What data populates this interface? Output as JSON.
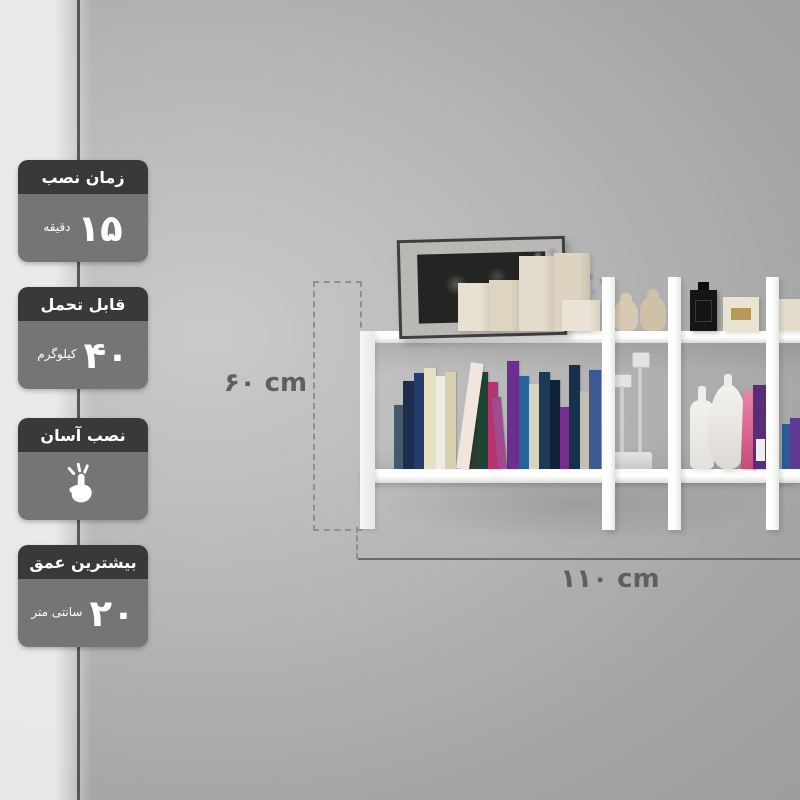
{
  "page": {
    "type": "product-infographic",
    "language": "fa",
    "subject": "wall-mounted-shelf"
  },
  "badges": [
    {
      "header": "زمان نصب",
      "value": "۱۵",
      "unit": "دقیقه"
    },
    {
      "header": "قابل تحمل",
      "value": "۴۰",
      "unit": "کیلوگرم"
    },
    {
      "header": "نصب آسان",
      "icon": "snap-fingers-icon"
    },
    {
      "header": "بیشترین عمق",
      "value": "۲۰",
      "unit": "سانتی متر"
    }
  ],
  "dimensions": {
    "height_label": "۶۰ cm",
    "width_label": "۱۱۰ cm"
  },
  "colors": {
    "badge_header": "#39393b",
    "badge_body": "#757578",
    "badge_text": "#ffffff",
    "dimension_text": "#5f5f5f",
    "wall_mid": "#a8a8a8",
    "shelf_white": "#fbfbfa"
  },
  "shelf": {
    "top_items": [
      "picture-frame",
      "lavender-flowers",
      "cream-gift-boxes",
      "figurines",
      "black-perfume-bottle",
      "cream-perfume-box"
    ],
    "middle_items": [
      "book-row",
      "glass-candlesticks",
      "white-bottle-vase",
      "mannequin-vase",
      "leaning-books"
    ],
    "books": [
      {
        "color": "#46586b",
        "h": 64,
        "w": 9
      },
      {
        "color": "#1e2c4e",
        "h": 88,
        "w": 11
      },
      {
        "color": "#223d6e",
        "h": 96,
        "w": 10
      },
      {
        "color": "#e8e0c4",
        "h": 101,
        "w": 12
      },
      {
        "color": "#efece3",
        "h": 93,
        "w": 9
      },
      {
        "color": "#d8cfae",
        "h": 97,
        "w": 11
      },
      {
        "color": "#f0e6de",
        "h": 107,
        "w": 13,
        "tilt": 8
      },
      {
        "color": "#2c3a31",
        "h": 91,
        "w": 9
      },
      {
        "color": "#1d4536",
        "h": 97,
        "w": 10
      },
      {
        "color": "#b8336e",
        "h": 87,
        "w": 10
      },
      {
        "color": "#a04b90",
        "h": 72,
        "w": 9,
        "tilt": -5
      },
      {
        "color": "#6a2f90",
        "h": 108,
        "w": 12
      },
      {
        "color": "#27649a",
        "h": 93,
        "w": 10
      },
      {
        "color": "#d9d3c0",
        "h": 85,
        "w": 10
      },
      {
        "color": "#1b3a56",
        "h": 97,
        "w": 11
      },
      {
        "color": "#0e2238",
        "h": 89,
        "w": 10
      },
      {
        "color": "#742f8a",
        "h": 62,
        "w": 9
      },
      {
        "color": "#173050",
        "h": 104,
        "w": 11
      },
      {
        "color": "#c2bfb2",
        "h": 78,
        "w": 9
      },
      {
        "color": "#3b5a91",
        "h": 99,
        "w": 12
      }
    ]
  }
}
